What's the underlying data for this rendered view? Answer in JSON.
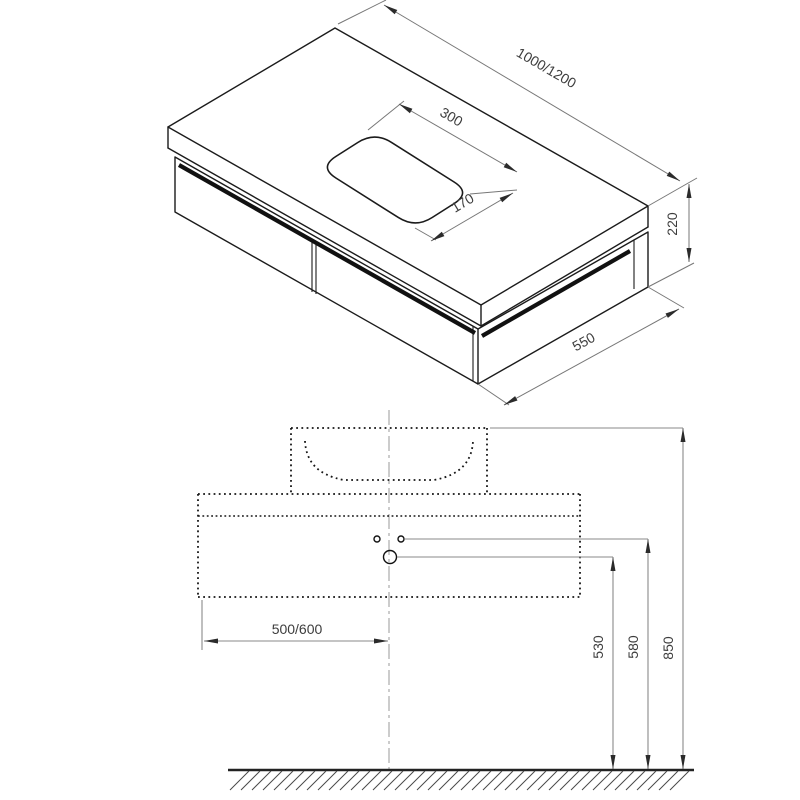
{
  "document": {
    "type": "technical dimension drawing",
    "subject": "wall-mounted vanity unit with countertop basin cutout, isometric view and front elevation",
    "background": "#ffffff"
  },
  "isometric_view": {
    "name": "isometric view of vanity cabinet",
    "labels": {
      "length": "1000/1200",
      "cutout_length": "300",
      "cutout_width": "170",
      "height": "220",
      "depth": "550"
    }
  },
  "front_view": {
    "name": "front elevation with mounting dimensions",
    "labels": {
      "basin_offset": "500/600",
      "outlet_height": "530",
      "holes_height": "580",
      "top_height": "850"
    },
    "features": [
      "washbasin outline",
      "bowl curve",
      "cabinet outline",
      "two small mounting holes",
      "one large outlet hole",
      "vertical centerline",
      "floor line with hatching"
    ]
  },
  "colors": {
    "outline": "#1b1b1b",
    "dimension_lines": "#777777",
    "front_dimension_lines": "#8a8a8a",
    "label_text": "#3d3d3d",
    "centerline": "#ababab",
    "ground": "#222222"
  }
}
